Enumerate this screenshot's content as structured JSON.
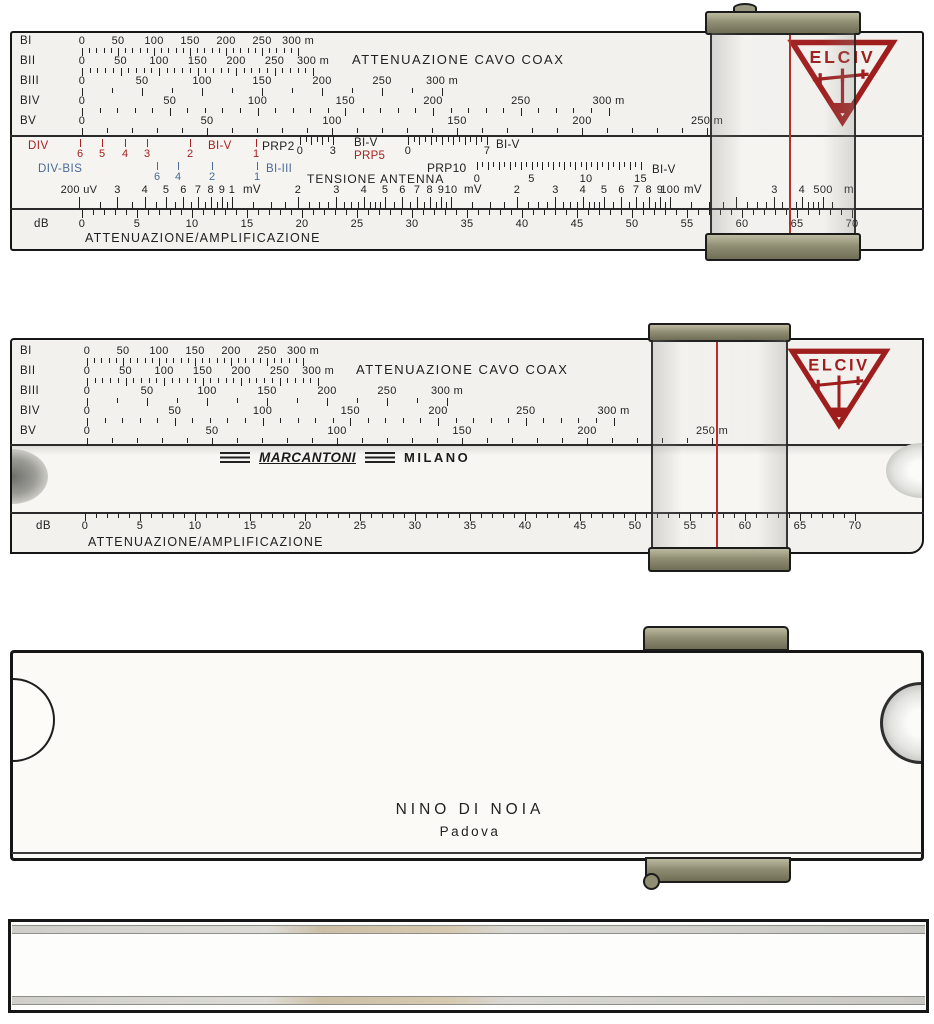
{
  "brand": {
    "name": "ELCIV"
  },
  "maker": {
    "name": "MARCANTONI",
    "city": "MILANO"
  },
  "owner": {
    "name": "NINO DI NOIA",
    "city": "Padova"
  },
  "colors": {
    "ink": "#1f1f1f",
    "red": "#a62222",
    "blue": "#4a6a96",
    "logo_red": "#9e1d1d",
    "hairline": "#b5302c",
    "metal": "#908e73",
    "paper": "#f2f1ed"
  },
  "texts": [
    {
      "t": "ATTENUAZIONE CAVO COAX",
      "x": 352,
      "y": 53,
      "size": 13,
      "ls": 1.5
    },
    {
      "t": "BI-V",
      "x": 208,
      "y": 141,
      "color": "red"
    },
    {
      "t": "PRP2",
      "x": 262,
      "y": 140,
      "size": 12
    },
    {
      "t": "BI-V",
      "x": 354,
      "y": 138
    },
    {
      "t": "PRP5",
      "x": 354,
      "y": 151,
      "color": "red"
    },
    {
      "t": "BI-V",
      "x": 496,
      "y": 140
    },
    {
      "t": "BI-III",
      "x": 266,
      "y": 164,
      "color": "blue"
    },
    {
      "t": "TENSIONE ANTENNA",
      "x": 307,
      "y": 173,
      "size": 12,
      "ls": 1
    },
    {
      "t": "PRP10",
      "x": 427,
      "y": 162,
      "size": 12
    },
    {
      "t": "BI-V",
      "x": 652,
      "y": 165
    },
    {
      "t": "mV",
      "x": 243,
      "y": 185
    },
    {
      "t": "mV",
      "x": 464,
      "y": 185
    },
    {
      "t": "mV",
      "x": 684,
      "y": 185
    },
    {
      "t": "m",
      "x": 844,
      "y": 185
    },
    {
      "t": "ATTENUAZIONE/AMPLIFICAZIONE",
      "x": 85,
      "y": 232,
      "size": 12.5,
      "ls": 1.2
    },
    {
      "t": "ATTENUAZIONE CAVO COAX",
      "x": 356,
      "y": 363,
      "size": 13,
      "ls": 1.5
    },
    {
      "t": "ATTENUAZIONE/AMPLIFICAZIONE",
      "x": 88,
      "y": 536,
      "size": 12.5,
      "ls": 1.2
    }
  ],
  "scales": [
    {
      "name": "r1-BI",
      "color": "ink",
      "side_label": {
        "t": "BI",
        "x": 20,
        "y": 36
      },
      "axis": {
        "type": "linear",
        "x0": 82,
        "ppu": 0.72,
        "min": 0,
        "max": 300,
        "minor": 10,
        "major": 50
      },
      "tick_y": 48,
      "major_h": 8,
      "minor_h": 5,
      "num_y": 36,
      "labels": [
        {
          "v": 0,
          "t": "0"
        },
        {
          "v": 50,
          "t": "50"
        },
        {
          "v": 100,
          "t": "100"
        },
        {
          "v": 150,
          "t": "150"
        },
        {
          "v": 200,
          "t": "200"
        },
        {
          "v": 250,
          "t": "250"
        },
        {
          "v": 300,
          "t": "300 m"
        }
      ]
    },
    {
      "name": "r1-BII",
      "color": "ink",
      "side_label": {
        "t": "BII",
        "x": 20,
        "y": 56
      },
      "axis": {
        "type": "linear",
        "x0": 82,
        "ppu": 0.77,
        "min": 0,
        "max": 300,
        "minor": 10,
        "major": 50
      },
      "tick_y": 68,
      "major_h": 8,
      "minor_h": 5,
      "num_y": 56,
      "labels": [
        {
          "v": 0,
          "t": "0"
        },
        {
          "v": 50,
          "t": "50"
        },
        {
          "v": 100,
          "t": "100"
        },
        {
          "v": 150,
          "t": "150"
        },
        {
          "v": 200,
          "t": "200"
        },
        {
          "v": 250,
          "t": "250"
        },
        {
          "v": 300,
          "t": "300 m"
        }
      ]
    },
    {
      "name": "r1-BIII",
      "color": "ink",
      "side_label": {
        "t": "BIII",
        "x": 20,
        "y": 76
      },
      "axis": {
        "type": "linear",
        "x0": 82,
        "ppu": 1.2,
        "min": 0,
        "max": 300,
        "minor": 25,
        "major": 50
      },
      "tick_y": 88,
      "major_h": 8,
      "minor_h": 5,
      "num_y": 76,
      "labels": [
        {
          "v": 0,
          "t": "0"
        },
        {
          "v": 50,
          "t": "50"
        },
        {
          "v": 100,
          "t": "100"
        },
        {
          "v": 150,
          "t": "150"
        },
        {
          "v": 200,
          "t": "200"
        },
        {
          "v": 250,
          "t": "250"
        },
        {
          "v": 300,
          "t": "300 m"
        }
      ]
    },
    {
      "name": "r1-BIV",
      "color": "ink",
      "side_label": {
        "t": "BIV",
        "x": 20,
        "y": 96
      },
      "axis": {
        "type": "linear",
        "x0": 82,
        "ppu": 1.755,
        "min": 0,
        "max": 300,
        "minor": 10,
        "major": 50
      },
      "tick_y": 108,
      "major_h": 8,
      "minor_h": 5,
      "num_y": 96,
      "labels": [
        {
          "v": 0,
          "t": "0"
        },
        {
          "v": 50,
          "t": "50"
        },
        {
          "v": 100,
          "t": "100"
        },
        {
          "v": 150,
          "t": "150"
        },
        {
          "v": 200,
          "t": "200"
        },
        {
          "v": 250,
          "t": "250"
        },
        {
          "v": 300,
          "t": "300 m"
        }
      ]
    },
    {
      "name": "r1-BV",
      "color": "ink",
      "side_label": {
        "t": "BV",
        "x": 20,
        "y": 116
      },
      "axis": {
        "type": "linear",
        "x0": 82,
        "ppu": 2.5,
        "min": 0,
        "max": 250,
        "minor": 10,
        "major": 50
      },
      "tick_y": 128,
      "major_h": 8,
      "minor_h": 5,
      "num_y": 116,
      "labels": [
        {
          "v": 0,
          "t": "0"
        },
        {
          "v": 50,
          "t": "50"
        },
        {
          "v": 100,
          "t": "100"
        },
        {
          "v": 150,
          "t": "150"
        },
        {
          "v": 200,
          "t": "200"
        },
        {
          "v": 250,
          "t": "250 m"
        }
      ]
    },
    {
      "name": "r1-DIV",
      "color": "red",
      "side_label": {
        "t": "DIV",
        "x": 28,
        "y": 141
      },
      "points": [
        {
          "x": 80,
          "t": "6"
        },
        {
          "x": 102,
          "t": "5"
        },
        {
          "x": 125,
          "t": "4"
        },
        {
          "x": 147,
          "t": "3"
        },
        {
          "x": 190,
          "t": "2"
        },
        {
          "x": 256,
          "t": "1"
        }
      ],
      "tick_y": 139,
      "major_h": 8,
      "minor_h": 8,
      "num_y": 149
    },
    {
      "name": "r1-PRP2",
      "color": "ink",
      "axis": {
        "type": "linear",
        "x0": 300,
        "ppu": 11,
        "min": 0,
        "max": 3,
        "minor": 0.5,
        "major": 1
      },
      "tick_y": 137,
      "major_h": 8,
      "minor_h": 5,
      "num_y": 146,
      "labels": [
        {
          "v": 0,
          "t": "0"
        },
        {
          "v": 3,
          "t": "3"
        }
      ]
    },
    {
      "name": "r1-PRP5",
      "color": "ink",
      "axis": {
        "type": "linear",
        "x0": 408,
        "ppu": 11.3,
        "min": 0,
        "max": 7,
        "minor": 0.5,
        "major": 1
      },
      "tick_y": 137,
      "major_h": 8,
      "minor_h": 5,
      "num_y": 146,
      "labels": [
        {
          "v": 0,
          "t": "0"
        },
        {
          "v": 7,
          "t": "7"
        }
      ]
    },
    {
      "name": "r1-DIV-BIS",
      "color": "blue",
      "side_label": {
        "t": "DIV-BIS",
        "x": 38,
        "y": 164
      },
      "points": [
        {
          "x": 157,
          "t": "6"
        },
        {
          "x": 178,
          "t": "4"
        },
        {
          "x": 212,
          "t": "2"
        },
        {
          "x": 257,
          "t": "1"
        }
      ],
      "tick_y": 162,
      "major_h": 8,
      "minor_h": 8,
      "num_y": 172
    },
    {
      "name": "r1-PRP10",
      "color": "ink",
      "axis": {
        "type": "linear",
        "x0": 477,
        "ppu": 10.9,
        "min": 0,
        "max": 15,
        "minor": 0.5,
        "major": 1
      },
      "tick_y": 162,
      "major_h": 8,
      "minor_h": 5,
      "num_y": 174,
      "labels": [
        {
          "v": 0,
          "t": "0"
        },
        {
          "v": 5,
          "t": "5"
        },
        {
          "v": 10,
          "t": "10"
        },
        {
          "v": 15,
          "t": "15"
        }
      ]
    },
    {
      "name": "r1-voltage",
      "color": "ink",
      "align": "bottom",
      "axis": {
        "type": "log",
        "x0": 232,
        "ppd": 219,
        "major_vals": [
          0.2,
          0.3,
          0.4,
          0.5,
          0.6,
          0.7,
          0.8,
          0.9,
          1,
          2,
          3,
          4,
          5,
          6,
          7,
          8,
          9,
          10,
          20,
          30,
          40,
          50,
          60,
          70,
          80,
          90,
          100,
          200,
          300,
          400,
          500
        ],
        "minor_vals": [
          0.25,
          0.35,
          0.45,
          0.55,
          0.65,
          0.75,
          0.85,
          0.95,
          1.25,
          1.5,
          1.75,
          2.25,
          2.5,
          2.75,
          3.25,
          3.5,
          3.75,
          4.25,
          4.5,
          4.75,
          5.5,
          6.5,
          7.5,
          8.5,
          9.5,
          12.5,
          15,
          17.5,
          22.5,
          25,
          27.5,
          32.5,
          35,
          37.5,
          42.5,
          45,
          47.5,
          55,
          65,
          75,
          85,
          95,
          125,
          150,
          175,
          225,
          250,
          275,
          325,
          350,
          375,
          425,
          450,
          475,
          550
        ]
      },
      "tick_y": 209,
      "major_h": 12,
      "minor_h": 7,
      "num_y": 185,
      "labels": [
        {
          "v": 0.2,
          "t": "200 uV"
        },
        {
          "v": 0.3,
          "t": "3"
        },
        {
          "v": 0.4,
          "t": "4"
        },
        {
          "v": 0.5,
          "t": "5"
        },
        {
          "v": 0.6,
          "t": "6"
        },
        {
          "v": 0.7,
          "t": "7"
        },
        {
          "v": 0.8,
          "t": "8"
        },
        {
          "v": 0.9,
          "t": "9"
        },
        {
          "v": 1,
          "t": "1"
        },
        {
          "v": 2,
          "t": "2"
        },
        {
          "v": 3,
          "t": "3"
        },
        {
          "v": 4,
          "t": "4"
        },
        {
          "v": 5,
          "t": "5"
        },
        {
          "v": 6,
          "t": "6"
        },
        {
          "v": 7,
          "t": "7"
        },
        {
          "v": 8,
          "t": "8"
        },
        {
          "v": 9,
          "t": "9"
        },
        {
          "v": 10,
          "t": "10"
        },
        {
          "v": 20,
          "t": "2"
        },
        {
          "v": 30,
          "t": "3"
        },
        {
          "v": 40,
          "t": "4"
        },
        {
          "v": 50,
          "t": "5"
        },
        {
          "v": 60,
          "t": "6"
        },
        {
          "v": 70,
          "t": "7"
        },
        {
          "v": 80,
          "t": "8"
        },
        {
          "v": 90,
          "t": "9"
        },
        {
          "v": 100,
          "t": "100"
        },
        {
          "v": 300,
          "t": "3"
        },
        {
          "v": 400,
          "t": "4"
        },
        {
          "v": 500,
          "t": "500"
        }
      ]
    },
    {
      "name": "r1-dB",
      "color": "ink",
      "side_label": {
        "t": "dB",
        "x": 34,
        "y": 219
      },
      "axis": {
        "type": "linear",
        "x0": 82,
        "ppu": 11,
        "min": 0,
        "max": 70,
        "minor": 1,
        "major": 5
      },
      "tick_y": 210,
      "major_h": 8,
      "minor_h": 5,
      "num_y": 219,
      "labels": [
        {
          "v": 0,
          "t": "0"
        },
        {
          "v": 5,
          "t": "5"
        },
        {
          "v": 10,
          "t": "10"
        },
        {
          "v": 15,
          "t": "15"
        },
        {
          "v": 20,
          "t": "20"
        },
        {
          "v": 25,
          "t": "25"
        },
        {
          "v": 30,
          "t": "30"
        },
        {
          "v": 35,
          "t": "35"
        },
        {
          "v": 40,
          "t": "40"
        },
        {
          "v": 45,
          "t": "45"
        },
        {
          "v": 50,
          "t": "50"
        },
        {
          "v": 55,
          "t": "55"
        },
        {
          "v": 60,
          "t": "60"
        },
        {
          "v": 65,
          "t": "65"
        },
        {
          "v": 70,
          "t": "70"
        }
      ]
    },
    {
      "name": "r2-BI",
      "color": "ink",
      "side_label": {
        "t": "BI",
        "x": 20,
        "y": 346
      },
      "axis": {
        "type": "linear",
        "x0": 87,
        "ppu": 0.72,
        "min": 0,
        "max": 300,
        "minor": 10,
        "major": 50
      },
      "tick_y": 358,
      "major_h": 8,
      "minor_h": 5,
      "num_y": 346,
      "labels": [
        {
          "v": 0,
          "t": "0"
        },
        {
          "v": 50,
          "t": "50"
        },
        {
          "v": 100,
          "t": "100"
        },
        {
          "v": 150,
          "t": "150"
        },
        {
          "v": 200,
          "t": "200"
        },
        {
          "v": 250,
          "t": "250"
        },
        {
          "v": 300,
          "t": "300 m"
        }
      ]
    },
    {
      "name": "r2-BII",
      "color": "ink",
      "side_label": {
        "t": "BII",
        "x": 20,
        "y": 366
      },
      "axis": {
        "type": "linear",
        "x0": 87,
        "ppu": 0.77,
        "min": 0,
        "max": 300,
        "minor": 10,
        "major": 50
      },
      "tick_y": 378,
      "major_h": 8,
      "minor_h": 5,
      "num_y": 366,
      "labels": [
        {
          "v": 0,
          "t": "0"
        },
        {
          "v": 50,
          "t": "50"
        },
        {
          "v": 100,
          "t": "100"
        },
        {
          "v": 150,
          "t": "150"
        },
        {
          "v": 200,
          "t": "200"
        },
        {
          "v": 250,
          "t": "250"
        },
        {
          "v": 300,
          "t": "300 m"
        }
      ]
    },
    {
      "name": "r2-BIII",
      "color": "ink",
      "side_label": {
        "t": "BIII",
        "x": 20,
        "y": 386
      },
      "axis": {
        "type": "linear",
        "x0": 87,
        "ppu": 1.2,
        "min": 0,
        "max": 300,
        "minor": 25,
        "major": 50
      },
      "tick_y": 398,
      "major_h": 8,
      "minor_h": 5,
      "num_y": 386,
      "labels": [
        {
          "v": 0,
          "t": "0"
        },
        {
          "v": 50,
          "t": "50"
        },
        {
          "v": 100,
          "t": "100"
        },
        {
          "v": 150,
          "t": "150"
        },
        {
          "v": 200,
          "t": "200"
        },
        {
          "v": 250,
          "t": "250"
        },
        {
          "v": 300,
          "t": "300 m"
        }
      ]
    },
    {
      "name": "r2-BIV",
      "color": "ink",
      "side_label": {
        "t": "BIV",
        "x": 20,
        "y": 406
      },
      "axis": {
        "type": "linear",
        "x0": 87,
        "ppu": 1.755,
        "min": 0,
        "max": 300,
        "minor": 10,
        "major": 50
      },
      "tick_y": 418,
      "major_h": 8,
      "minor_h": 5,
      "num_y": 406,
      "labels": [
        {
          "v": 0,
          "t": "0"
        },
        {
          "v": 50,
          "t": "50"
        },
        {
          "v": 100,
          "t": "100"
        },
        {
          "v": 150,
          "t": "150"
        },
        {
          "v": 200,
          "t": "200"
        },
        {
          "v": 250,
          "t": "250"
        },
        {
          "v": 300,
          "t": "300 m"
        }
      ]
    },
    {
      "name": "r2-BV",
      "color": "ink",
      "side_label": {
        "t": "BV",
        "x": 20,
        "y": 426
      },
      "axis": {
        "type": "linear",
        "x0": 87,
        "ppu": 2.5,
        "min": 0,
        "max": 250,
        "minor": 10,
        "major": 50
      },
      "tick_y": 438,
      "major_h": 8,
      "minor_h": 5,
      "num_y": 426,
      "labels": [
        {
          "v": 0,
          "t": "0"
        },
        {
          "v": 50,
          "t": "50"
        },
        {
          "v": 100,
          "t": "100"
        },
        {
          "v": 150,
          "t": "150"
        },
        {
          "v": 200,
          "t": "200"
        },
        {
          "v": 250,
          "t": "250 m"
        }
      ]
    },
    {
      "name": "r2-dB",
      "color": "ink",
      "side_label": {
        "t": "dB",
        "x": 36,
        "y": 521
      },
      "axis": {
        "type": "linear",
        "x0": 85,
        "ppu": 11,
        "min": 0,
        "max": 70,
        "minor": 1,
        "major": 5
      },
      "tick_y": 513,
      "major_h": 8,
      "minor_h": 5,
      "num_y": 521,
      "labels": [
        {
          "v": 0,
          "t": "0"
        },
        {
          "v": 5,
          "t": "5"
        },
        {
          "v": 10,
          "t": "10"
        },
        {
          "v": 15,
          "t": "15"
        },
        {
          "v": 20,
          "t": "20"
        },
        {
          "v": 25,
          "t": "25"
        },
        {
          "v": 30,
          "t": "30"
        },
        {
          "v": 35,
          "t": "35"
        },
        {
          "v": 40,
          "t": "40"
        },
        {
          "v": 45,
          "t": "45"
        },
        {
          "v": 50,
          "t": "50"
        },
        {
          "v": 55,
          "t": "55"
        },
        {
          "v": 60,
          "t": "60"
        },
        {
          "v": 65,
          "t": "65"
        },
        {
          "v": 70,
          "t": "70"
        }
      ]
    }
  ]
}
